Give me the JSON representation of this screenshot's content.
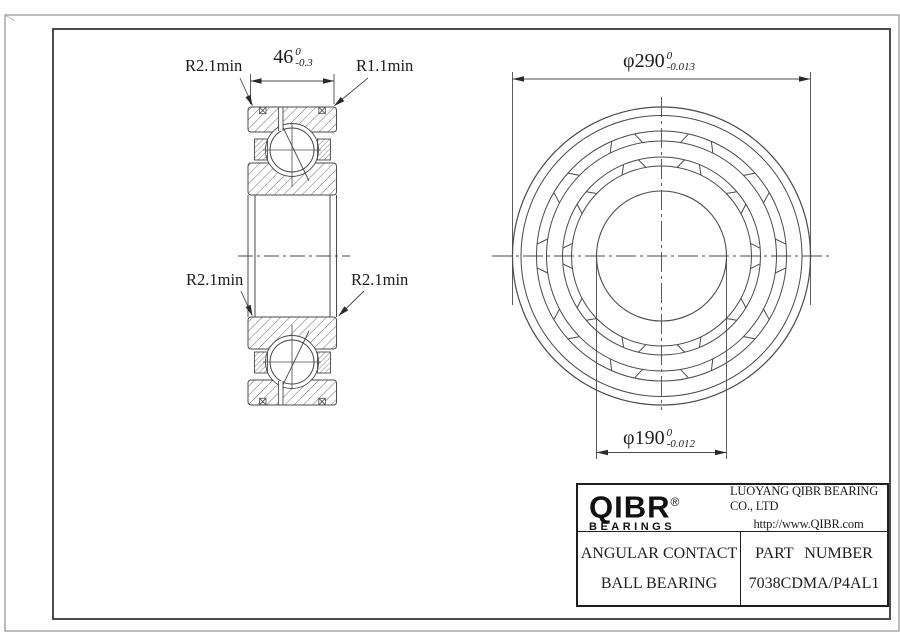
{
  "annotations": {
    "top_left_radius": "R2.1min",
    "top_right_radius": "R1.1min",
    "mid_left_radius": "R2.1min",
    "mid_right_radius": "R2.1min"
  },
  "dimensions": {
    "width": {
      "value": "46",
      "tol_top": "0",
      "tol_bottom": "-0.3"
    },
    "outer_diameter": {
      "symbol": "φ",
      "value": "290",
      "tol_top": "0",
      "tol_bottom": "-0.013"
    },
    "bore_diameter": {
      "symbol": "φ",
      "value": "190",
      "tol_top": "0",
      "tol_bottom": "-0.012"
    }
  },
  "title_block": {
    "logo_text": "QIBR",
    "logo_registered": "®",
    "logo_sub": "BEARINGS",
    "company": "LUOYANG QIBR BEARING CO., LTD",
    "url": "http://www.QIBR.com",
    "product_line1": "ANGULAR CONTACT",
    "product_line2": "BALL BEARING",
    "part_label": "PART NUMBER",
    "part_number": "7038CDMA/P4AL1"
  },
  "colors": {
    "line": "#4a4a4a",
    "text": "#1c1c1c",
    "border_outer": "#979797",
    "border_inner": "#4d4d4d"
  }
}
